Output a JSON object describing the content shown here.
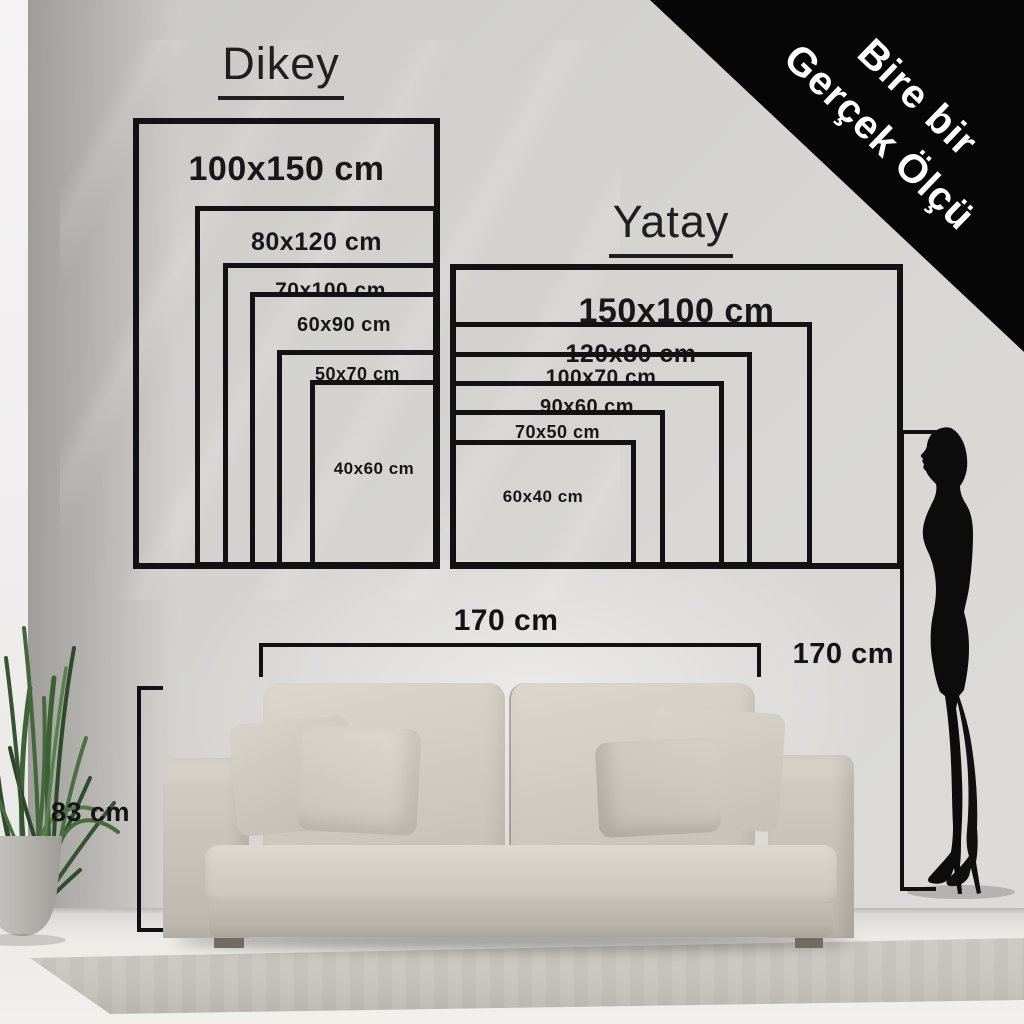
{
  "banner": {
    "line1": "Bire bir",
    "line2": "Gerçek Ölçü"
  },
  "dikey": {
    "title": "Dikey",
    "sizes": [
      "100x150 cm",
      "80x120 cm",
      "70x100 cm",
      "60x90 cm",
      "50x70 cm",
      "40x60 cm"
    ]
  },
  "yatay": {
    "title": "Yatay",
    "sizes": [
      "150x100 cm",
      "120x80 cm",
      "100x70 cm",
      "90x60 cm",
      "70x50 cm",
      "60x40 cm"
    ]
  },
  "measurements": {
    "sofa_width": "170 cm",
    "sofa_height": "83 cm",
    "person_height": "170 cm"
  },
  "colors": {
    "outline": "#121212",
    "banner_bg": "#060606",
    "banner_text": "#ffffff",
    "wall": "#d3d2cf",
    "sofa": "#d2cdc3"
  }
}
